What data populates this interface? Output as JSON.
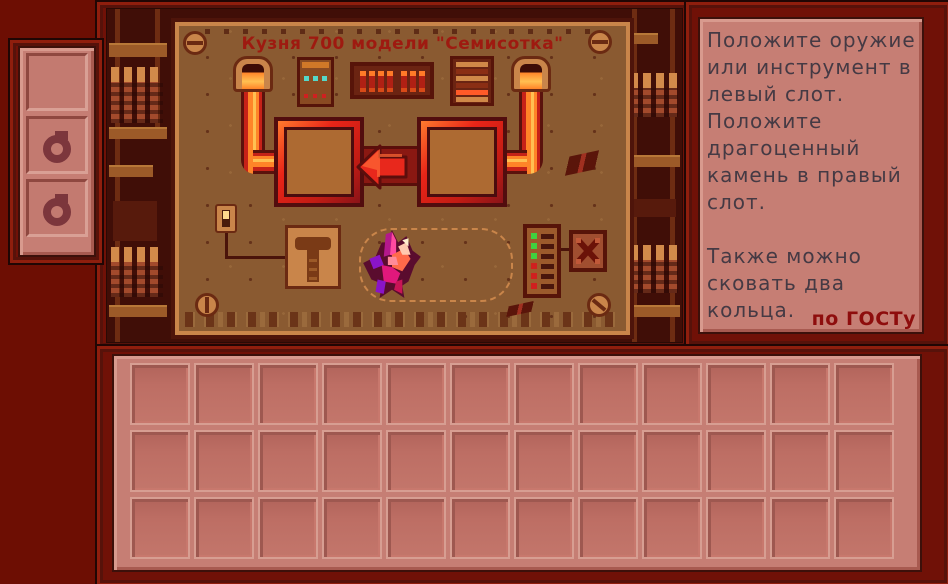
{
  "forge": {
    "title": "Кузня 700 модели \"Семисотка\"",
    "title_color": "#9e1a10",
    "left_slot_hint": "weapon-or-tool-slot",
    "right_slot_hint": "gem-slot",
    "arrow_direction": "left",
    "leds": [
      "green",
      "green",
      "green",
      "red",
      "red",
      "red"
    ]
  },
  "instructions": {
    "text": "Положите оружие\nили инструмент в\nлевый слот.\nПоложите\nдрагоценный\nкамень в правый\nслот.\n\nТакже можно\nсковать два\nкольца.",
    "stamp": "по ГОСТу",
    "text_color": "#453a44",
    "stamp_color": "#8e0d0d"
  },
  "ring_panel": {
    "slots": [
      {
        "icon": ""
      },
      {
        "icon": "ring-icon"
      },
      {
        "icon": "ring-icon"
      }
    ]
  },
  "inventory": {
    "rows": 3,
    "cols": 12
  },
  "icons": {
    "arrow": "left-arrow-icon",
    "crystal": "gem-crystal-icon",
    "hammer": "hammer-icon",
    "x_mark": "x-mark-icon",
    "screw": "screw-icon",
    "ring": "ring-icon"
  },
  "colors": {
    "background": "#6d0e03",
    "frame": "#701107",
    "machine_face": "#8a5a31",
    "machine_trim": "#c9854a",
    "pink_face": "#c67e74",
    "slot_glow": "#e8281c",
    "pipe": "#ff8428",
    "led_green": "#3fd13f",
    "led_red": "#d01f1f"
  }
}
